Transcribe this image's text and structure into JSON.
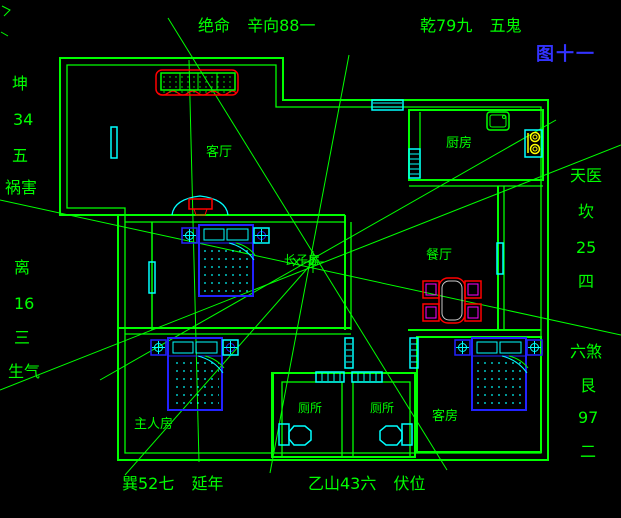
{
  "figure": {
    "caption": "图十一"
  },
  "annotations": {
    "top_left": "绝命 辛向88一",
    "top_right": "乾79九 五鬼",
    "left_upper": [
      "坤",
      "34",
      "五",
      "祸害"
    ],
    "left_lower": [
      "离",
      "16",
      "三",
      "生气"
    ],
    "right_upper": [
      "天医",
      "坎",
      "25",
      "四"
    ],
    "right_lower": [
      "六煞",
      "艮",
      "97",
      "二"
    ],
    "bottom_left": "巽52七 延年",
    "bottom_center": "乙山43六 伏位"
  },
  "rooms": {
    "living": "客厅",
    "kitchen": "厨房",
    "dining": "餐厅",
    "eldest_son": "长子房",
    "master": "主人房",
    "toilet_left": "厕所",
    "toilet_right": "厕所",
    "guest": "客房"
  },
  "colors": {
    "background": "#000000",
    "walls_and_text": "#00ff00",
    "windows_pipes": "#00ffff",
    "beds_cabinets": "#2222ff",
    "sofa_tv_table_outline": "#ff0000",
    "figure_caption": "#3333ff",
    "stove_burners": "#ffff00",
    "chair_inner": "#ff00ff"
  }
}
